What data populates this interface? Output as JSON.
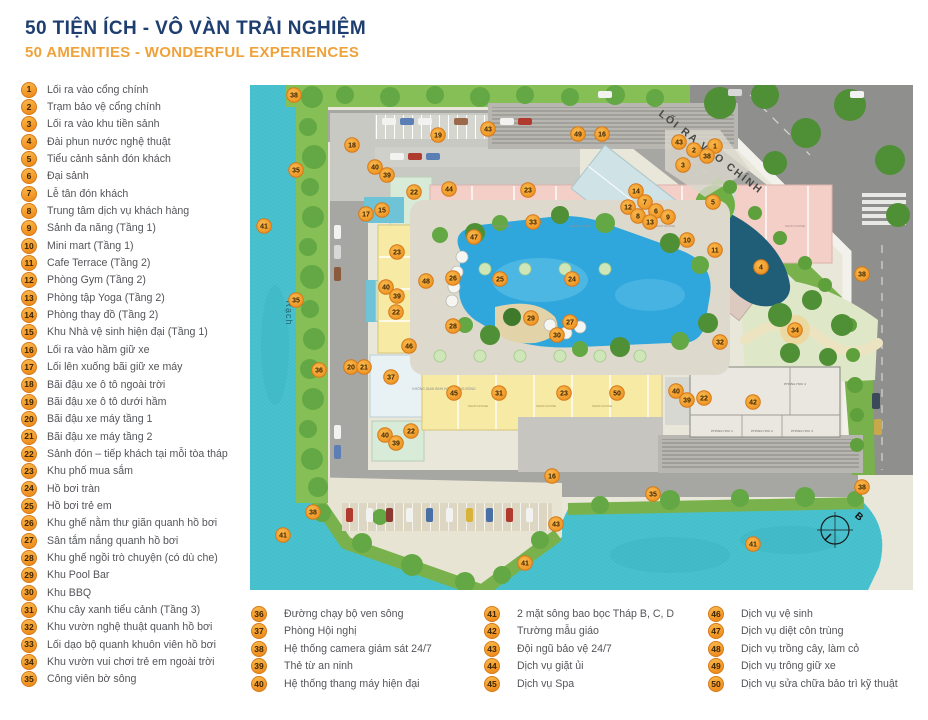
{
  "header": {
    "title": "50 TIỆN ÍCH - VÔ VÀN TRẢI NGHIỆM",
    "subtitle": "50 AMENITIES - WONDERFUL EXPERIENCES"
  },
  "colors": {
    "title_navy": "#1e3e70",
    "subtitle_orange": "#f0a23a",
    "badge_orange": "#ee8c1c",
    "badge_border": "#d5791a",
    "badge_text": "#3d2505",
    "legend_text": "#54555a",
    "river_water": "#49c2cf",
    "pool_blue": "#2fa7dc",
    "greenery": "#76b954",
    "road_gray": "#a6a6a2",
    "asphalt": "#8f8f8d",
    "shop_yellow": "#f6eaa4",
    "shop_pink": "#f3cfc8"
  },
  "legend": {
    "left_items": [
      {
        "num": "1",
        "label": "Lối ra vào cổng chính"
      },
      {
        "num": "2",
        "label": "Trạm bảo vệ cổng chính"
      },
      {
        "num": "3",
        "label": "Lối ra vào khu tiền sảnh"
      },
      {
        "num": "4",
        "label": "Đài phun nước nghệ thuật"
      },
      {
        "num": "5",
        "label": "Tiểu cảnh sảnh đón khách"
      },
      {
        "num": "6",
        "label": "Đại sảnh"
      },
      {
        "num": "7",
        "label": "Lễ tân đón khách"
      },
      {
        "num": "8",
        "label": "Trung tâm dịch vụ khách hàng"
      },
      {
        "num": "9",
        "label": "Sảnh đa năng (Tầng 1)"
      },
      {
        "num": "10",
        "label": "Mini mart (Tầng 1)"
      },
      {
        "num": "11",
        "label": "Cafe Terrace (Tầng 2)"
      },
      {
        "num": "12",
        "label": "Phòng Gym (Tầng 2)"
      },
      {
        "num": "13",
        "label": "Phòng tập Yoga (Tầng 2)"
      },
      {
        "num": "14",
        "label": "Phòng thay đồ (Tầng 2)"
      },
      {
        "num": "15",
        "label": "Khu Nhà vệ sinh hiện đại (Tầng 1)"
      },
      {
        "num": "16",
        "label": "Lối ra vào hầm giữ xe"
      },
      {
        "num": "17",
        "label": "Lối lên xuống bãi giữ xe máy"
      },
      {
        "num": "18",
        "label": "Bãi đậu xe ô tô ngoài trời"
      },
      {
        "num": "19",
        "label": "Bãi đậu xe ô tô dưới hầm"
      },
      {
        "num": "20",
        "label": "Bãi đậu xe máy tầng 1"
      },
      {
        "num": "21",
        "label": "Bãi đậu xe máy tầng 2"
      },
      {
        "num": "22",
        "label": "Sảnh đón – tiếp khách tại mỗi tòa tháp"
      },
      {
        "num": "23",
        "label": "Khu phố mua sắm"
      },
      {
        "num": "24",
        "label": "Hồ bơi tràn"
      },
      {
        "num": "25",
        "label": "Hồ bơi trẻ em"
      },
      {
        "num": "26",
        "label": "Khu ghế nằm thư giãn quanh hồ bơi"
      },
      {
        "num": "27",
        "label": "Sân tắm nắng quanh hồ bơi"
      },
      {
        "num": "28",
        "label": "Khu ghế ngồi trò chuyện (có dù che)"
      },
      {
        "num": "29",
        "label": "Khu Pool Bar"
      },
      {
        "num": "30",
        "label": "Khu BBQ"
      },
      {
        "num": "31",
        "label": "Khu cây xanh tiểu cảnh (Tầng 3)"
      },
      {
        "num": "32",
        "label": "Khu vườn nghệ thuật quanh hồ bơi"
      },
      {
        "num": "33",
        "label": "Lối dạo bộ quanh khuôn viên hồ bơi"
      },
      {
        "num": "34",
        "label": "Khu vườn vui chơi trẻ em ngoài trời"
      },
      {
        "num": "35",
        "label": "Công viên bờ sông"
      }
    ],
    "bottom_columns": [
      [
        {
          "num": "36",
          "label": "Đường chạy bộ ven sông"
        },
        {
          "num": "37",
          "label": "Phòng Hội nghị"
        },
        {
          "num": "38",
          "label": "Hệ thống camera giám sát 24/7"
        },
        {
          "num": "39",
          "label": "Thẻ từ an ninh"
        },
        {
          "num": "40",
          "label": "Hệ thống thang máy hiện đại"
        }
      ],
      [
        {
          "num": "41",
          "label": "2 mặt sông bao bọc Tháp B, C, D"
        },
        {
          "num": "42",
          "label": "Trường mẫu giáo"
        },
        {
          "num": "43",
          "label": "Đội ngũ bảo vệ 24/7"
        },
        {
          "num": "44",
          "label": "Dịch vụ giặt ủi"
        },
        {
          "num": "45",
          "label": "Dịch vụ Spa"
        }
      ],
      [
        {
          "num": "46",
          "label": "Dịch vụ vệ sinh"
        },
        {
          "num": "47",
          "label": "Dịch vụ diệt côn trùng"
        },
        {
          "num": "48",
          "label": "Dịch vụ trồng cây, làm cỏ"
        },
        {
          "num": "49",
          "label": "Dịch vụ trông giữ xe"
        },
        {
          "num": "50",
          "label": "Dịch vụ sửa chữa bảo trì kỹ thuật"
        }
      ]
    ]
  },
  "map": {
    "texts": [
      {
        "t": "LỐI RA VÀO CHÍNH",
        "x": 408,
        "y": 30,
        "rot": 38,
        "size": 10.5,
        "color": "#474744",
        "ls": 2,
        "w": 600,
        "anchor": "start"
      },
      {
        "t": "Rạch",
        "x": 36,
        "y": 228,
        "rot": 90,
        "size": 9,
        "color": "#1d6570",
        "ls": 1,
        "w": 400,
        "anchor": "middle"
      },
      {
        "t": "B",
        "x": 607,
        "y": 434,
        "rot": 40,
        "size": 10,
        "color": "#111111",
        "ls": 0,
        "w": 700,
        "anchor": "middle"
      },
      {
        "t": "KHÔNG GIAN SINH HOẠT CỘNG ĐỒNG",
        "x": 194,
        "y": 305,
        "rot": 0,
        "size": 3.4,
        "color": "#8a8a8a",
        "ls": 0,
        "w": 400,
        "anchor": "middle"
      },
      {
        "t": "SHOP HOUSE",
        "x": 228,
        "y": 322,
        "rot": 0,
        "size": 3,
        "color": "#a8934a",
        "ls": 0,
        "w": 400,
        "anchor": "middle"
      },
      {
        "t": "SHOP HOUSE",
        "x": 296,
        "y": 322,
        "rot": 0,
        "size": 3,
        "color": "#a8934a",
        "ls": 0,
        "w": 400,
        "anchor": "middle"
      },
      {
        "t": "SHOP HOUSE",
        "x": 352,
        "y": 322,
        "rot": 0,
        "size": 3,
        "color": "#a8934a",
        "ls": 0,
        "w": 400,
        "anchor": "middle"
      },
      {
        "t": "SHOP HOUSE",
        "x": 252,
        "y": 142,
        "rot": 0,
        "size": 3,
        "color": "#a88888",
        "ls": 0,
        "w": 400,
        "anchor": "middle"
      },
      {
        "t": "SHOP HOUSE",
        "x": 330,
        "y": 142,
        "rot": 0,
        "size": 3,
        "color": "#a88888",
        "ls": 0,
        "w": 400,
        "anchor": "middle"
      },
      {
        "t": "SHOP HOUSE",
        "x": 415,
        "y": 142,
        "rot": 0,
        "size": 3,
        "color": "#a88888",
        "ls": 0,
        "w": 400,
        "anchor": "middle"
      },
      {
        "t": "SHOP HOUSE",
        "x": 545,
        "y": 142,
        "rot": 0,
        "size": 3,
        "color": "#a88888",
        "ls": 0,
        "w": 400,
        "anchor": "middle"
      },
      {
        "t": "PHÒNG HỌC 4",
        "x": 545,
        "y": 300,
        "rot": 0,
        "size": 3.1,
        "color": "#666666",
        "ls": 0,
        "w": 400,
        "anchor": "middle"
      },
      {
        "t": "PHÒNG HỌC 1",
        "x": 472,
        "y": 347,
        "rot": 0,
        "size": 3.1,
        "color": "#666666",
        "ls": 0,
        "w": 400,
        "anchor": "middle"
      },
      {
        "t": "PHÒNG HỌC 2",
        "x": 512,
        "y": 347,
        "rot": 0,
        "size": 3.1,
        "color": "#666666",
        "ls": 0,
        "w": 400,
        "anchor": "middle"
      },
      {
        "t": "PHÒNG HỌC 3",
        "x": 552,
        "y": 347,
        "rot": 0,
        "size": 3.1,
        "color": "#666666",
        "ls": 0,
        "w": 400,
        "anchor": "middle"
      }
    ],
    "markers": [
      {
        "n": "38",
        "x": 44,
        "y": 10
      },
      {
        "n": "35",
        "x": 46,
        "y": 85
      },
      {
        "n": "41",
        "x": 14,
        "y": 141
      },
      {
        "n": "35",
        "x": 46,
        "y": 215
      },
      {
        "n": "36",
        "x": 69,
        "y": 285
      },
      {
        "n": "38",
        "x": 63,
        "y": 427
      },
      {
        "n": "41",
        "x": 33,
        "y": 450
      },
      {
        "n": "18",
        "x": 102,
        "y": 60
      },
      {
        "n": "19",
        "x": 188,
        "y": 50
      },
      {
        "n": "43",
        "x": 238,
        "y": 44
      },
      {
        "n": "49",
        "x": 328,
        "y": 49
      },
      {
        "n": "16",
        "x": 352,
        "y": 49
      },
      {
        "n": "40",
        "x": 125,
        "y": 82
      },
      {
        "n": "39",
        "x": 137,
        "y": 90
      },
      {
        "n": "22",
        "x": 164,
        "y": 107
      },
      {
        "n": "44",
        "x": 199,
        "y": 104
      },
      {
        "n": "23",
        "x": 278,
        "y": 105
      },
      {
        "n": "17",
        "x": 116,
        "y": 129
      },
      {
        "n": "15",
        "x": 132,
        "y": 125
      },
      {
        "n": "23",
        "x": 147,
        "y": 167
      },
      {
        "n": "46",
        "x": 159,
        "y": 261
      },
      {
        "n": "33",
        "x": 283,
        "y": 137
      },
      {
        "n": "47",
        "x": 224,
        "y": 152
      },
      {
        "n": "48",
        "x": 176,
        "y": 196
      },
      {
        "n": "26",
        "x": 203,
        "y": 193
      },
      {
        "n": "25",
        "x": 250,
        "y": 194
      },
      {
        "n": "24",
        "x": 322,
        "y": 194
      },
      {
        "n": "28",
        "x": 203,
        "y": 241
      },
      {
        "n": "29",
        "x": 281,
        "y": 233
      },
      {
        "n": "27",
        "x": 320,
        "y": 237
      },
      {
        "n": "30",
        "x": 307,
        "y": 250
      },
      {
        "n": "40",
        "x": 136,
        "y": 202
      },
      {
        "n": "39",
        "x": 147,
        "y": 211
      },
      {
        "n": "22",
        "x": 146,
        "y": 227
      },
      {
        "n": "20",
        "x": 101,
        "y": 282
      },
      {
        "n": "21",
        "x": 114,
        "y": 282
      },
      {
        "n": "37",
        "x": 141,
        "y": 292
      },
      {
        "n": "45",
        "x": 204,
        "y": 308
      },
      {
        "n": "31",
        "x": 249,
        "y": 308
      },
      {
        "n": "23",
        "x": 314,
        "y": 308
      },
      {
        "n": "50",
        "x": 367,
        "y": 308
      },
      {
        "n": "40",
        "x": 426,
        "y": 306
      },
      {
        "n": "39",
        "x": 437,
        "y": 315
      },
      {
        "n": "22",
        "x": 454,
        "y": 313
      },
      {
        "n": "42",
        "x": 503,
        "y": 317
      },
      {
        "n": "40",
        "x": 135,
        "y": 350
      },
      {
        "n": "39",
        "x": 146,
        "y": 358
      },
      {
        "n": "22",
        "x": 161,
        "y": 346
      },
      {
        "n": "43",
        "x": 429,
        "y": 57
      },
      {
        "n": "2",
        "x": 444,
        "y": 65
      },
      {
        "n": "1",
        "x": 465,
        "y": 61
      },
      {
        "n": "38",
        "x": 457,
        "y": 71
      },
      {
        "n": "3",
        "x": 433,
        "y": 80
      },
      {
        "n": "14",
        "x": 386,
        "y": 106
      },
      {
        "n": "7",
        "x": 395,
        "y": 117
      },
      {
        "n": "12",
        "x": 378,
        "y": 122
      },
      {
        "n": "6",
        "x": 406,
        "y": 126
      },
      {
        "n": "8",
        "x": 388,
        "y": 131
      },
      {
        "n": "13",
        "x": 400,
        "y": 137
      },
      {
        "n": "9",
        "x": 418,
        "y": 132
      },
      {
        "n": "5",
        "x": 463,
        "y": 117
      },
      {
        "n": "10",
        "x": 437,
        "y": 155
      },
      {
        "n": "11",
        "x": 465,
        "y": 165
      },
      {
        "n": "4",
        "x": 511,
        "y": 182
      },
      {
        "n": "38",
        "x": 612,
        "y": 189
      },
      {
        "n": "34",
        "x": 545,
        "y": 245
      },
      {
        "n": "32",
        "x": 470,
        "y": 257
      },
      {
        "n": "16",
        "x": 302,
        "y": 391
      },
      {
        "n": "43",
        "x": 306,
        "y": 439
      },
      {
        "n": "35",
        "x": 403,
        "y": 409
      },
      {
        "n": "38",
        "x": 612,
        "y": 402
      },
      {
        "n": "41",
        "x": 275,
        "y": 478
      },
      {
        "n": "41",
        "x": 503,
        "y": 459
      }
    ]
  }
}
